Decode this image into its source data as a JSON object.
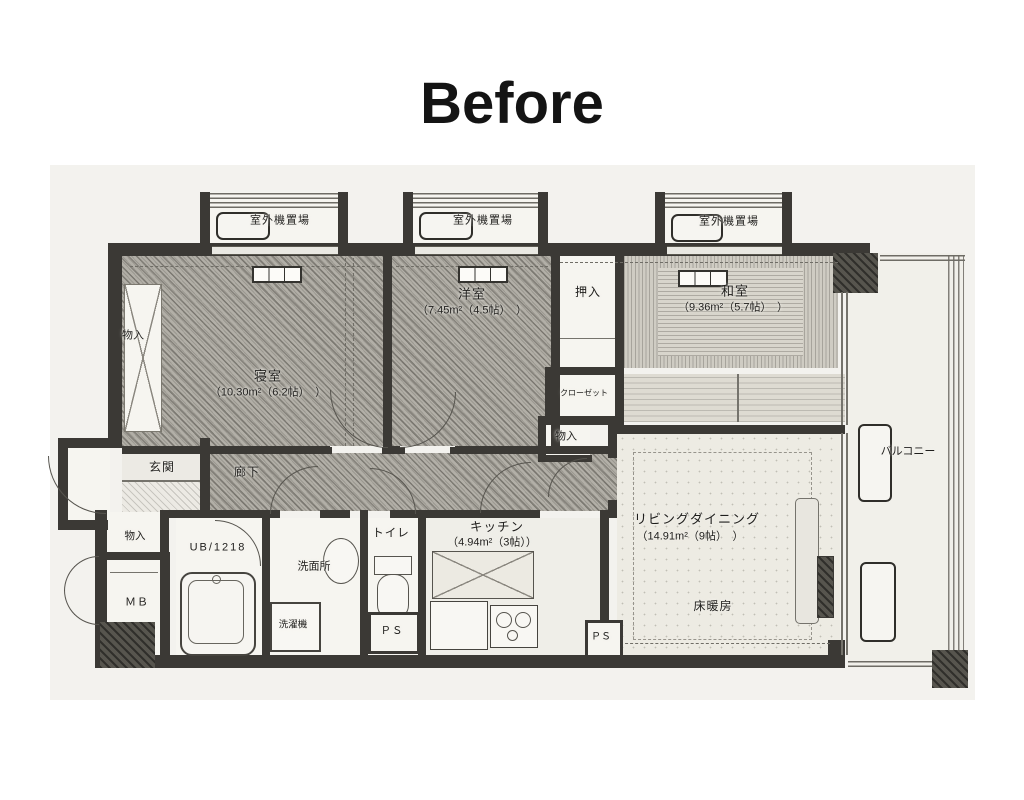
{
  "title": "Before",
  "colors": {
    "wall": "#3b3935",
    "paper": "#f3f2ee",
    "hatch_floor": "#b2afa7",
    "tatami": "#d8d5cc"
  },
  "plan": {
    "outdoor_unit": "室外機置場",
    "bedroom_name": "寝室",
    "bedroom_area": "（10.30m²（6.2帖）　）",
    "western_name": "洋室",
    "western_area": "（7.45m²（4.5帖）　）",
    "japanese_name": "和室",
    "japanese_area": "（9.36m²（5.7帖）　）",
    "living_name": "リビングダイニング",
    "living_area": "（14.91m²（9帖）　）",
    "kitchen_name": "キッチン",
    "kitchen_area": "（4.94m²（3帖））",
    "oshiire": "押入",
    "closet": "クローゼット",
    "storage": "物入",
    "entrance": "玄関",
    "hallway": "廊下",
    "balcony": "バルコニー",
    "floor_heating": "床暖房",
    "toilet": "トイレ",
    "washroom": "洗面所",
    "washer": "洗濯機",
    "unit_bath": "UB/1218",
    "meter_box": "ＭＢ",
    "pipe_space": "ＰＳ"
  }
}
